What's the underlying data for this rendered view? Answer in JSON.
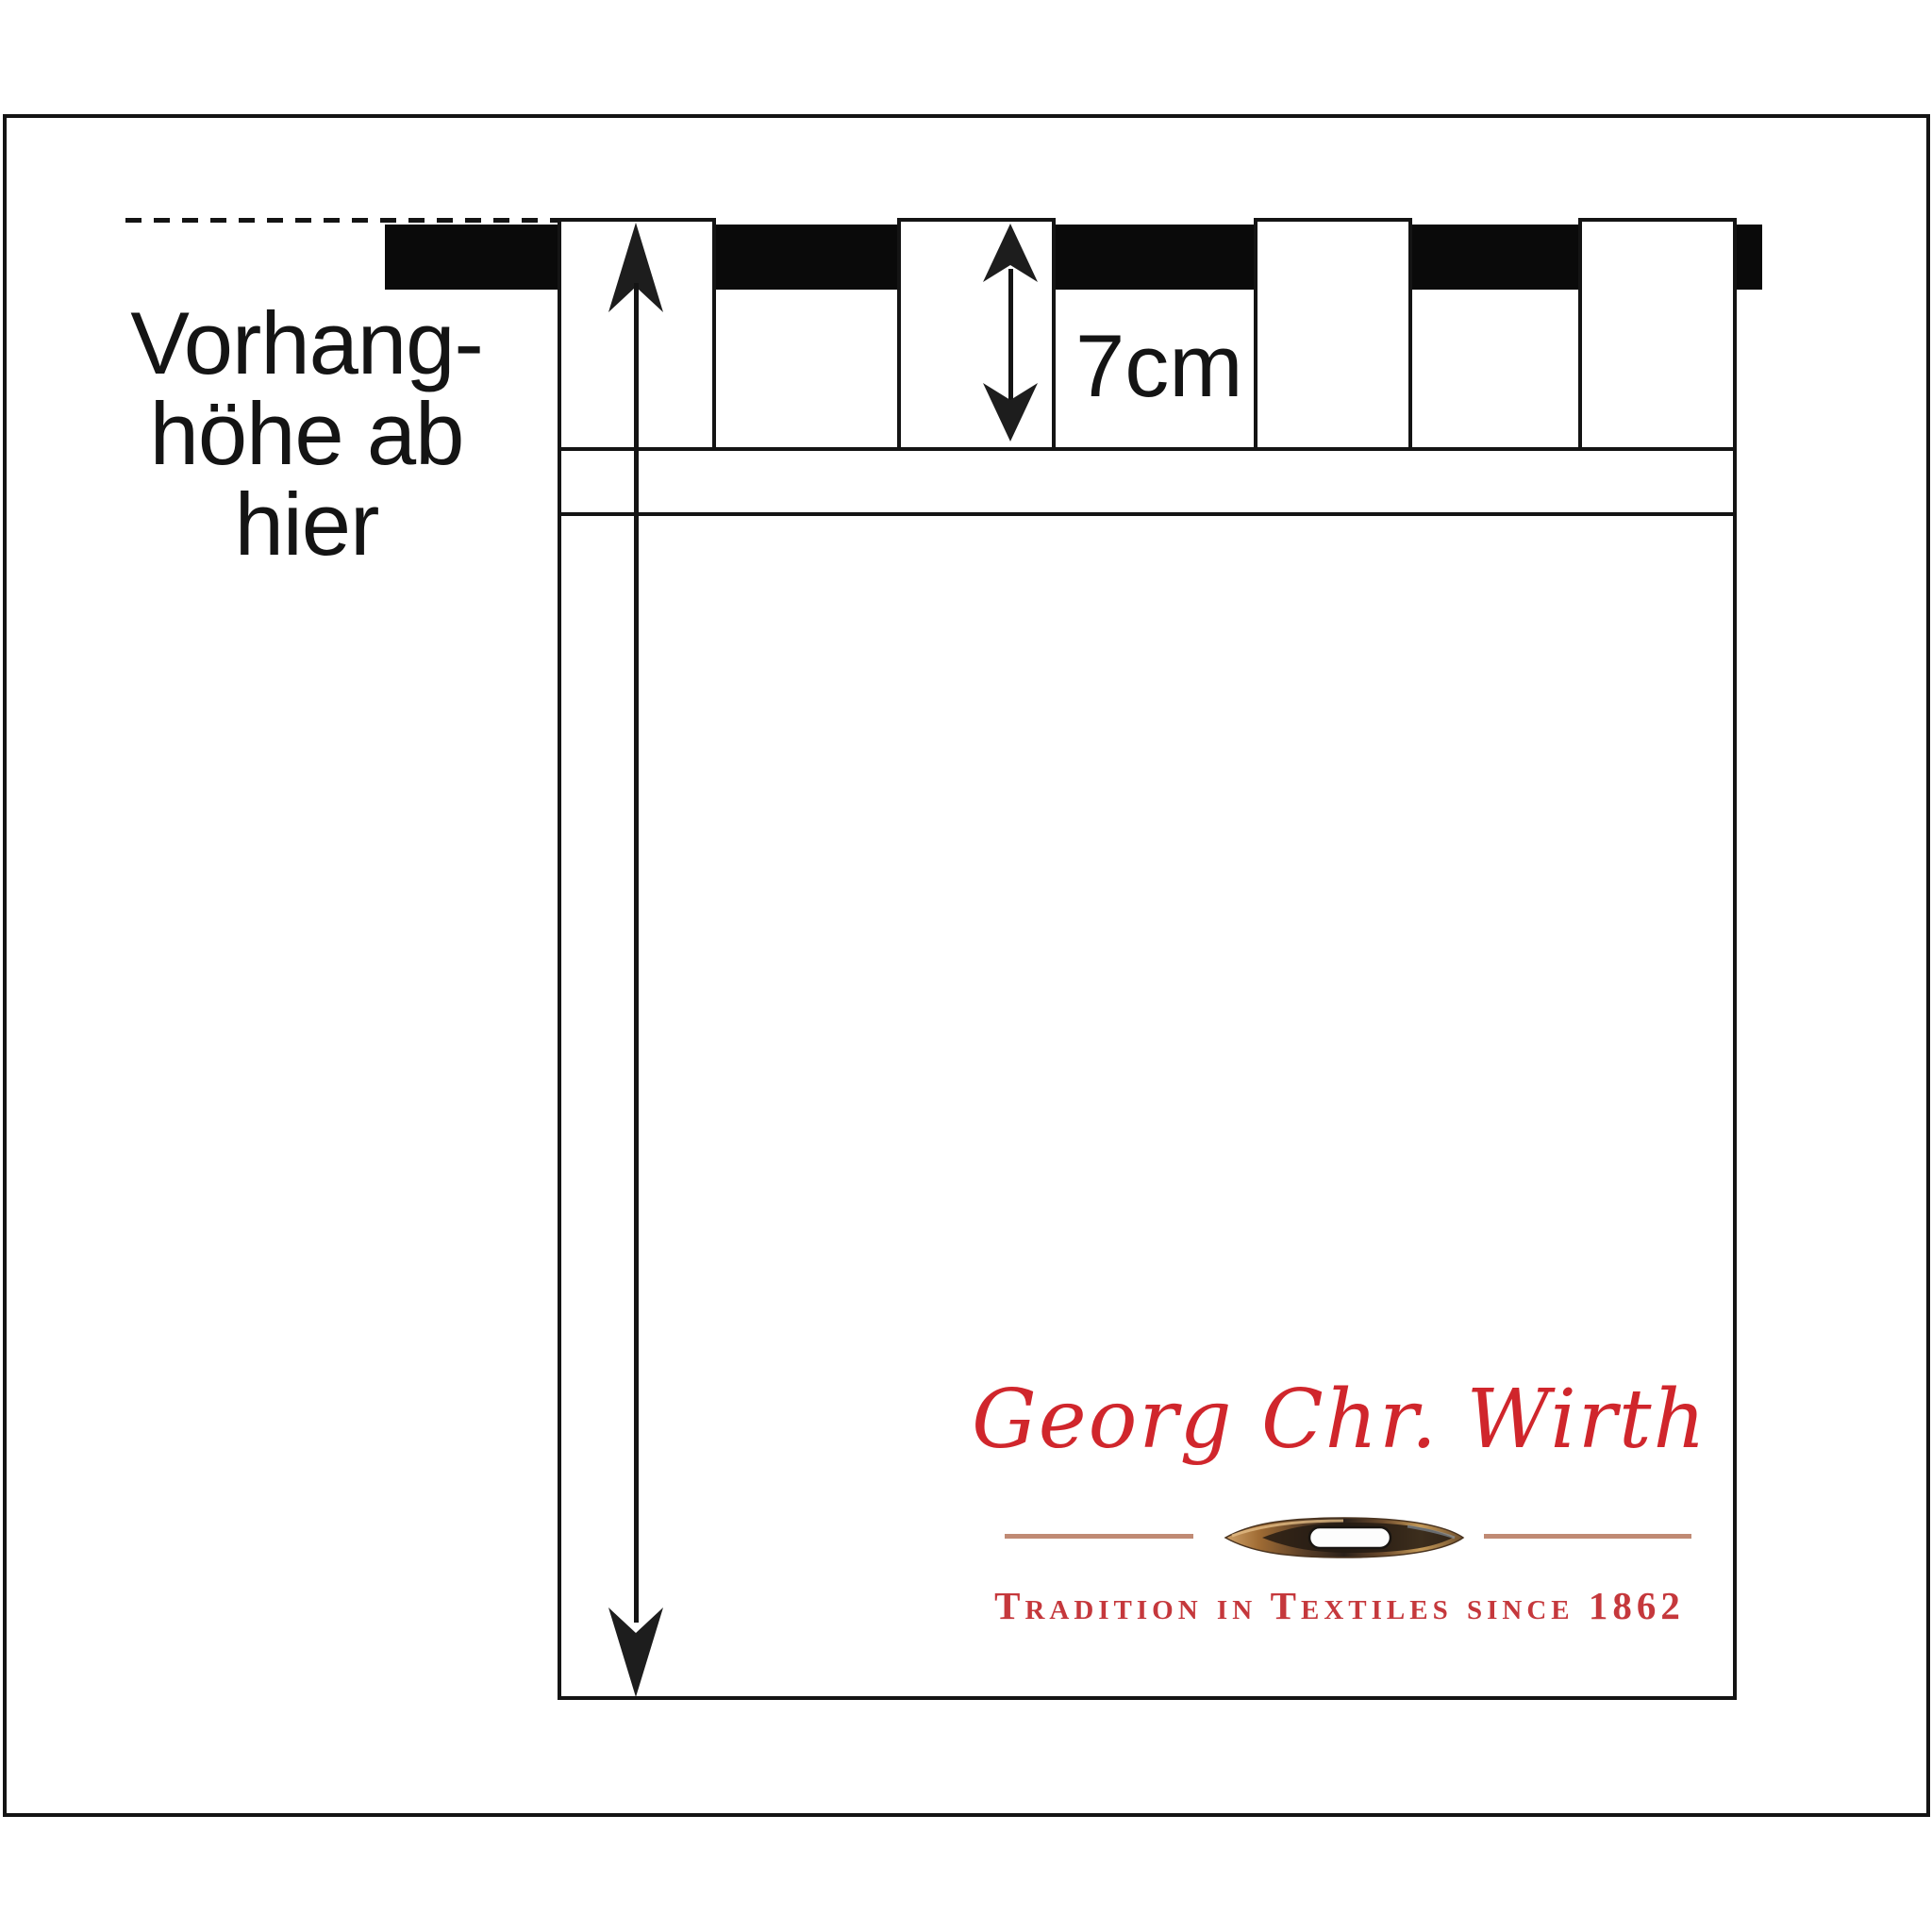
{
  "colors": {
    "ink": "#141414",
    "rod-black": "#0a0a0a",
    "brand-red": "#d0262c",
    "tagline-red": "#c5383c",
    "divider-tan": "#c08a74",
    "paper": "#ffffff"
  },
  "curtain_label": {
    "line1": "Vorhang-",
    "line2": "höhe ab",
    "line3": "hier"
  },
  "tab_label": {
    "text": "7cm"
  },
  "logo": {
    "title": "Georg Chr. Wirth",
    "tagline": "Tradition in Textiles since 1862",
    "needle_icon": "sewing-needle"
  },
  "diagram": {
    "tab_count": 4,
    "tab_height_value": "7cm",
    "reference_line_style": "dashed",
    "arrowhead_style": "barbed"
  }
}
